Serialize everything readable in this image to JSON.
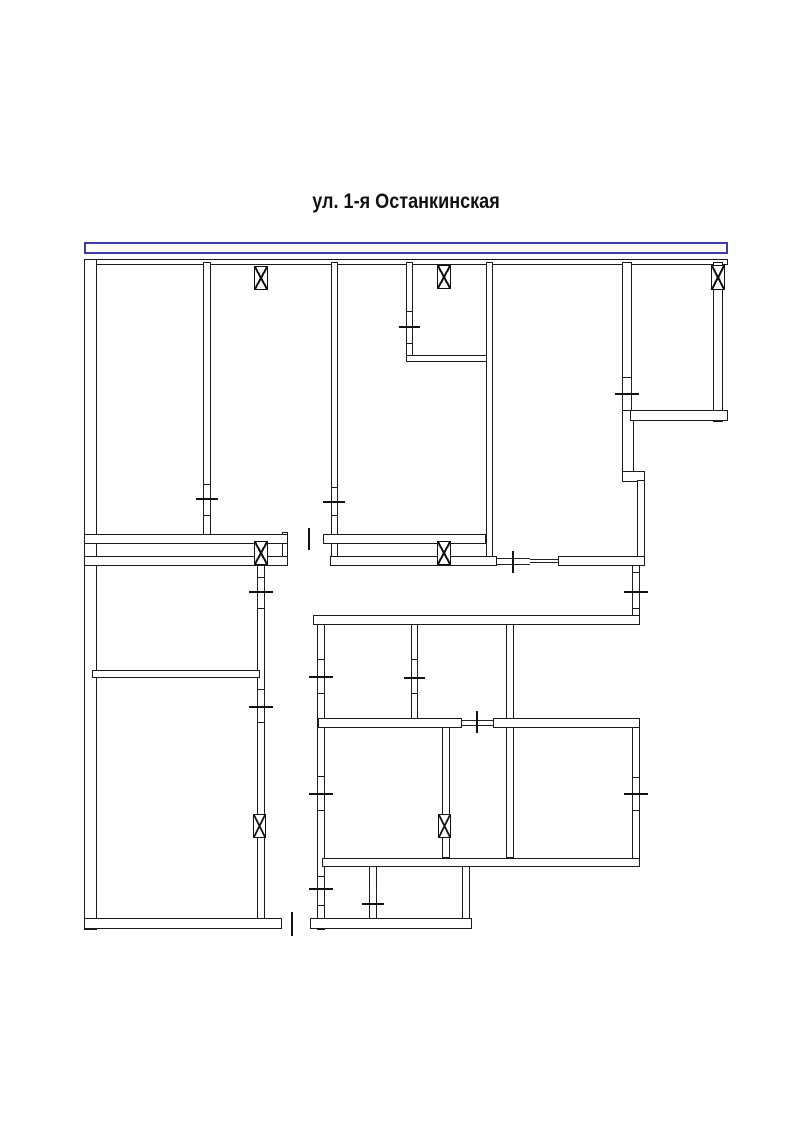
{
  "page": {
    "title": "ул. 1-я Останкинская",
    "background": "#ffffff"
  },
  "street": {
    "band_color": "#3d3da6",
    "band": {
      "x": 84,
      "y": 242,
      "w": 644,
      "h": 12
    }
  },
  "plan": {
    "wall_color": "#1b1b1b",
    "walls": [
      {
        "x": 84,
        "y": 259,
        "w": 644,
        "h": 6
      },
      {
        "x": 84,
        "y": 259,
        "w": 13,
        "h": 671
      },
      {
        "x": 203,
        "y": 262,
        "w": 8,
        "h": 223
      },
      {
        "x": 203,
        "y": 515,
        "w": 8,
        "h": 22
      },
      {
        "x": 331,
        "y": 262,
        "w": 7,
        "h": 226
      },
      {
        "x": 331,
        "y": 515,
        "w": 7,
        "h": 45
      },
      {
        "x": 406,
        "y": 262,
        "w": 7,
        "h": 50
      },
      {
        "x": 406,
        "y": 343,
        "w": 7,
        "h": 15
      },
      {
        "x": 406,
        "y": 355,
        "w": 81,
        "h": 7
      },
      {
        "x": 486,
        "y": 262,
        "w": 7,
        "h": 300
      },
      {
        "x": 622,
        "y": 262,
        "w": 10,
        "h": 116
      },
      {
        "x": 622,
        "y": 410,
        "w": 12,
        "h": 63
      },
      {
        "x": 713,
        "y": 262,
        "w": 10,
        "h": 160
      },
      {
        "x": 630,
        "y": 410,
        "w": 98,
        "h": 11
      },
      {
        "x": 622,
        "y": 471,
        "w": 23,
        "h": 11
      },
      {
        "x": 637,
        "y": 480,
        "w": 8,
        "h": 84
      },
      {
        "x": 632,
        "y": 562,
        "w": 8,
        "h": 11
      },
      {
        "x": 632,
        "y": 608,
        "w": 8,
        "h": 17
      },
      {
        "x": 257,
        "y": 565,
        "w": 8,
        "h": 13
      },
      {
        "x": 257,
        "y": 608,
        "w": 8,
        "h": 82
      },
      {
        "x": 257,
        "y": 722,
        "w": 8,
        "h": 198
      },
      {
        "x": 317,
        "y": 619,
        "w": 8,
        "h": 41
      },
      {
        "x": 317,
        "y": 693,
        "w": 8,
        "h": 84
      },
      {
        "x": 317,
        "y": 810,
        "w": 8,
        "h": 67
      },
      {
        "x": 317,
        "y": 905,
        "w": 8,
        "h": 25
      },
      {
        "x": 411,
        "y": 619,
        "w": 7,
        "h": 41
      },
      {
        "x": 411,
        "y": 693,
        "w": 7,
        "h": 32
      },
      {
        "x": 442,
        "y": 725,
        "w": 8,
        "h": 133
      },
      {
        "x": 506,
        "y": 619,
        "w": 8,
        "h": 239
      },
      {
        "x": 632,
        "y": 725,
        "w": 8,
        "h": 53
      },
      {
        "x": 632,
        "y": 810,
        "w": 8,
        "h": 57
      },
      {
        "x": 369,
        "y": 862,
        "w": 8,
        "h": 60
      },
      {
        "x": 462,
        "y": 862,
        "w": 8,
        "h": 63
      },
      {
        "x": 282,
        "y": 532,
        "w": 6,
        "h": 33
      },
      {
        "x": 84,
        "y": 534,
        "w": 204,
        "h": 10
      },
      {
        "x": 323,
        "y": 534,
        "w": 163,
        "h": 10
      },
      {
        "x": 84,
        "y": 556,
        "w": 204,
        "h": 10
      },
      {
        "x": 330,
        "y": 556,
        "w": 167,
        "h": 10
      },
      {
        "x": 558,
        "y": 556,
        "w": 87,
        "h": 10
      },
      {
        "x": 313,
        "y": 615,
        "w": 327,
        "h": 10
      },
      {
        "x": 92,
        "y": 670,
        "w": 168,
        "h": 8
      },
      {
        "x": 318,
        "y": 718,
        "w": 144,
        "h": 10
      },
      {
        "x": 493,
        "y": 718,
        "w": 147,
        "h": 10
      },
      {
        "x": 322,
        "y": 858,
        "w": 318,
        "h": 9
      },
      {
        "x": 84,
        "y": 918,
        "w": 198,
        "h": 11
      },
      {
        "x": 310,
        "y": 918,
        "w": 162,
        "h": 11
      }
    ],
    "windows": [
      {
        "x": 203,
        "y": 485,
        "w": 8,
        "h": 30,
        "dir": "v"
      },
      {
        "x": 331,
        "y": 488,
        "w": 7,
        "h": 27,
        "dir": "v"
      },
      {
        "x": 406,
        "y": 312,
        "w": 7,
        "h": 31,
        "dir": "v"
      },
      {
        "x": 622,
        "y": 378,
        "w": 10,
        "h": 32,
        "dir": "v"
      },
      {
        "x": 632,
        "y": 573,
        "w": 8,
        "h": 35,
        "dir": "v"
      },
      {
        "x": 632,
        "y": 778,
        "w": 8,
        "h": 32,
        "dir": "v"
      },
      {
        "x": 257,
        "y": 578,
        "w": 8,
        "h": 30,
        "dir": "v"
      },
      {
        "x": 257,
        "y": 690,
        "w": 8,
        "h": 32,
        "dir": "v"
      },
      {
        "x": 317,
        "y": 660,
        "w": 8,
        "h": 33,
        "dir": "v"
      },
      {
        "x": 317,
        "y": 777,
        "w": 8,
        "h": 33,
        "dir": "v"
      },
      {
        "x": 317,
        "y": 877,
        "w": 8,
        "h": 28,
        "dir": "v"
      },
      {
        "x": 369,
        "y": 886,
        "w": 8,
        "h": 11,
        "dir": "v"
      },
      {
        "x": 411,
        "y": 660,
        "w": 7,
        "h": 33,
        "dir": "v"
      },
      {
        "x": 462,
        "y": 720,
        "w": 31,
        "h": 6,
        "dir": "h"
      },
      {
        "x": 497,
        "y": 558,
        "w": 33,
        "h": 7,
        "dir": "h"
      },
      {
        "x": 530,
        "y": 559,
        "w": 28,
        "h": 4,
        "dir": "h"
      }
    ],
    "ticks": [
      {
        "x": 196,
        "y": 498,
        "w": 22,
        "h": 2
      },
      {
        "x": 323,
        "y": 501,
        "w": 22,
        "h": 2
      },
      {
        "x": 399,
        "y": 326,
        "w": 21,
        "h": 2
      },
      {
        "x": 615,
        "y": 393,
        "w": 24,
        "h": 2
      },
      {
        "x": 624,
        "y": 591,
        "w": 24,
        "h": 2
      },
      {
        "x": 624,
        "y": 793,
        "w": 24,
        "h": 2
      },
      {
        "x": 249,
        "y": 591,
        "w": 24,
        "h": 2
      },
      {
        "x": 249,
        "y": 706,
        "w": 24,
        "h": 2
      },
      {
        "x": 309,
        "y": 676,
        "w": 24,
        "h": 2
      },
      {
        "x": 309,
        "y": 793,
        "w": 24,
        "h": 2
      },
      {
        "x": 309,
        "y": 888,
        "w": 24,
        "h": 2
      },
      {
        "x": 404,
        "y": 677,
        "w": 21,
        "h": 2
      },
      {
        "x": 362,
        "y": 903,
        "w": 22,
        "h": 2
      },
      {
        "x": 308,
        "y": 528,
        "w": 2,
        "h": 22
      },
      {
        "x": 512,
        "y": 551,
        "w": 2,
        "h": 22
      },
      {
        "x": 476,
        "y": 711,
        "w": 2,
        "h": 22
      },
      {
        "x": 291,
        "y": 912,
        "w": 2,
        "h": 24
      }
    ],
    "vents": [
      {
        "x": 254,
        "y": 266,
        "w": 14,
        "h": 24
      },
      {
        "x": 437,
        "y": 265,
        "w": 14,
        "h": 24
      },
      {
        "x": 711,
        "y": 265,
        "w": 14,
        "h": 25
      },
      {
        "x": 254,
        "y": 541,
        "w": 14,
        "h": 24
      },
      {
        "x": 437,
        "y": 541,
        "w": 14,
        "h": 24
      },
      {
        "x": 253,
        "y": 814,
        "w": 13,
        "h": 24
      },
      {
        "x": 438,
        "y": 814,
        "w": 13,
        "h": 24
      }
    ]
  }
}
